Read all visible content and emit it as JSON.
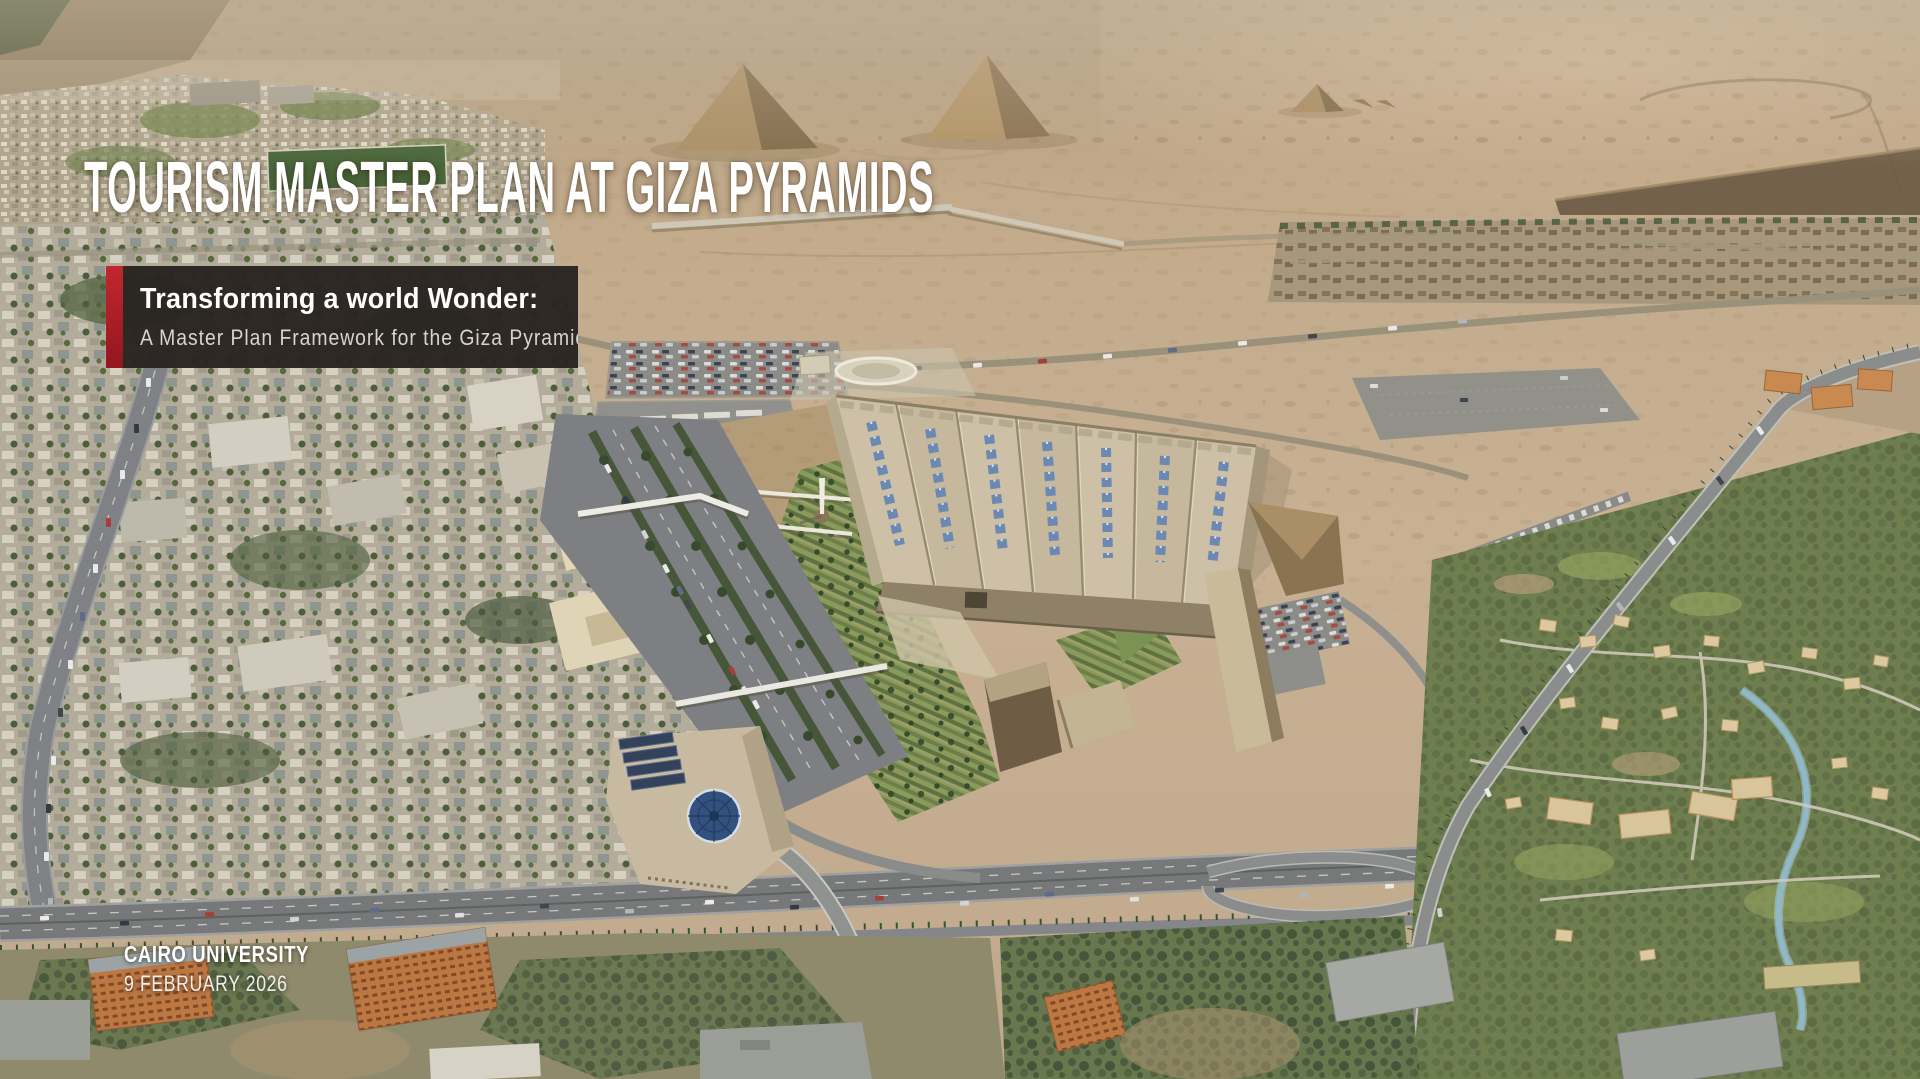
{
  "slide": {
    "title": "TOURISM MASTER PLAN AT  GIZA PYRAMIDS",
    "overlay": {
      "heading": "Transforming a world Wonder:",
      "subheading": "A Master Plan Framework for the Giza Pyramids"
    },
    "footer": {
      "organization": "CAIRO UNIVERSITY",
      "date": "9 FEBRUARY 2026"
    },
    "colors": {
      "accent_red": "#b2252b",
      "overlay_panel": "#2a2421",
      "title_text": "#ffffff",
      "subheading_text": "#d6d3d0"
    },
    "background": {
      "description": "Aerial render of the Giza plateau: Great Pyramids, Grand Egyptian Museum with solar-panel roof, visitor parking, landscaped gardens, Pyramids Avenue, highway interchange, Cairo University campus and residential districts"
    }
  }
}
